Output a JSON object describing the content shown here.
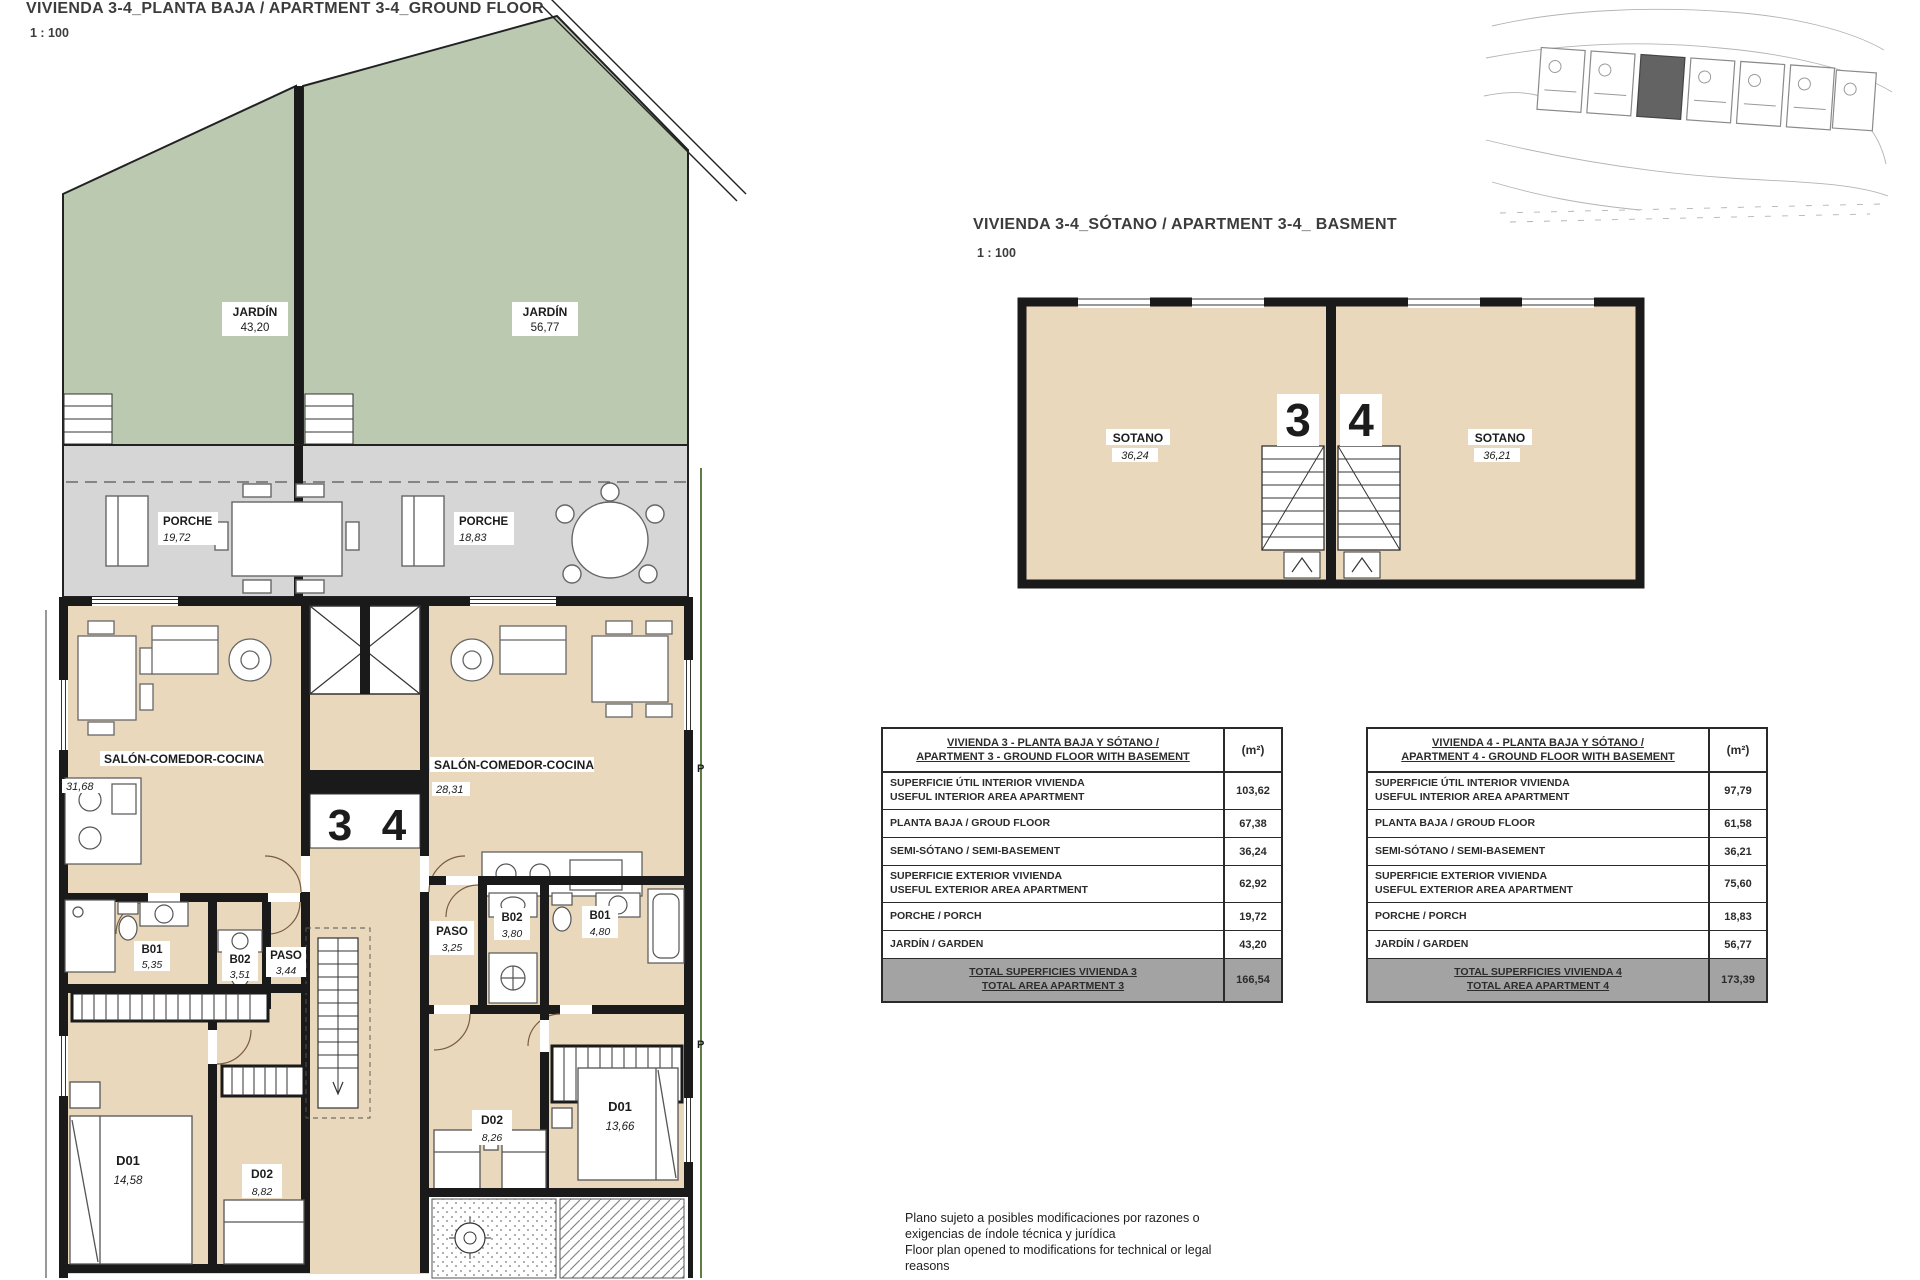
{
  "ground_floor": {
    "title": "VIVIENDA 3-4_PLANTA BAJA / APARTMENT 3-4_GROUND FLOOR",
    "scale": "1 : 100",
    "unit3": "3",
    "unit4": "4",
    "marker_p": "P",
    "rooms": {
      "jardin_left": {
        "label": "JARDÍN",
        "area": "43,20"
      },
      "jardin_right": {
        "label": "JARDÍN",
        "area": "56,77"
      },
      "porche_left": {
        "label": "PORCHE",
        "area": "19,72"
      },
      "porche_right": {
        "label": "PORCHE",
        "area": "18,83"
      },
      "salon_left": {
        "label": "SALÓN-COMEDOR-COCINA",
        "area": "31,68"
      },
      "salon_right": {
        "label": "SALÓN-COMEDOR-COCINA",
        "area": "28,31"
      },
      "b01_left": {
        "label": "B01",
        "area": "5,35"
      },
      "b02_left": {
        "label": "B02",
        "area": "3,51"
      },
      "paso_left": {
        "label": "PASO",
        "area": "3,44"
      },
      "d01_left": {
        "label": "D01",
        "area": "14,58"
      },
      "d02_left": {
        "label": "D02",
        "area": "8,82"
      },
      "paso_right": {
        "label": "PASO",
        "area": "3,25"
      },
      "b02_right": {
        "label": "B02",
        "area": "3,80"
      },
      "b01_right": {
        "label": "B01",
        "area": "4,80"
      },
      "d02_right": {
        "label": "D02",
        "area": "8,26"
      },
      "d01_right": {
        "label": "D01",
        "area": "13,66"
      }
    }
  },
  "basement": {
    "title": "VIVIENDA 3-4_SÓTANO / APARTMENT 3-4_ BASMENT",
    "scale": "1 : 100",
    "unit3": "3",
    "unit4": "4",
    "rooms": {
      "sotano_left": {
        "label": "SOTANO",
        "area": "36,24"
      },
      "sotano_right": {
        "label": "SOTANO",
        "area": "36,21"
      }
    }
  },
  "tables": [
    {
      "title_line1": "VIVIENDA 3 - PLANTA BAJA Y SÓTANO /",
      "title_line2": "APARTMENT 3 - GROUND FLOOR WITH BASEMENT",
      "unit_header": "(m²)",
      "rows": [
        {
          "label1": "SUPERFICIE ÚTIL INTERIOR VIVIENDA",
          "label2": "USEFUL INTERIOR AREA APARTMENT",
          "value": "103,62"
        },
        {
          "label1": "PLANTA BAJA / GROUD FLOOR",
          "value": "67,38"
        },
        {
          "label1": "SEMI-SÓTANO / SEMI-BASEMENT",
          "value": "36,24"
        },
        {
          "label1": "SUPERFICIE EXTERIOR VIVIENDA",
          "label2": "USEFUL EXTERIOR AREA APARTMENT",
          "value": "62,92"
        },
        {
          "label1": "PORCHE / PORCH",
          "value": "19,72"
        },
        {
          "label1": "JARDÍN / GARDEN",
          "value": "43,20"
        }
      ],
      "total1": "TOTAL SUPERFICIES VIVIENDA 3",
      "total2": "TOTAL AREA APARTMENT 3",
      "total_value": "166,54"
    },
    {
      "title_line1": "VIVIENDA 4 - PLANTA BAJA Y SÓTANO /",
      "title_line2": "APARTMENT 4 - GROUND FLOOR WITH BASEMENT",
      "unit_header": "(m²)",
      "rows": [
        {
          "label1": "SUPERFICIE ÚTIL INTERIOR VIVIENDA",
          "label2": "USEFUL INTERIOR AREA APARTMENT",
          "value": "97,79"
        },
        {
          "label1": "PLANTA BAJA / GROUD FLOOR",
          "value": "61,58"
        },
        {
          "label1": "SEMI-SÓTANO / SEMI-BASEMENT",
          "value": "36,21"
        },
        {
          "label1": "SUPERFICIE EXTERIOR VIVIENDA",
          "label2": "USEFUL EXTERIOR AREA APARTMENT",
          "value": "75,60"
        },
        {
          "label1": "PORCHE / PORCH",
          "value": "18,83"
        },
        {
          "label1": "JARDÍN / GARDEN",
          "value": "56,77"
        }
      ],
      "total1": "TOTAL SUPERFICIES VIVIENDA 4",
      "total2": "TOTAL AREA APARTMENT 4",
      "total_value": "173,39"
    }
  ],
  "disclaimer": {
    "line1": "Plano sujeto a posibles modificaciones por razones o",
    "line2": "exigencias de índole técnica y jurídica",
    "line3": "Floor plan opened to modifications for technical or legal",
    "line4": "reasons"
  },
  "colors": {
    "garden": "#bac9b0",
    "porch": "#d6d6d6",
    "interior": "#e9d8bb",
    "wall": "#1a1a1a",
    "total_row": "#a3a3a3",
    "boundary_green": "#5d7f46"
  }
}
